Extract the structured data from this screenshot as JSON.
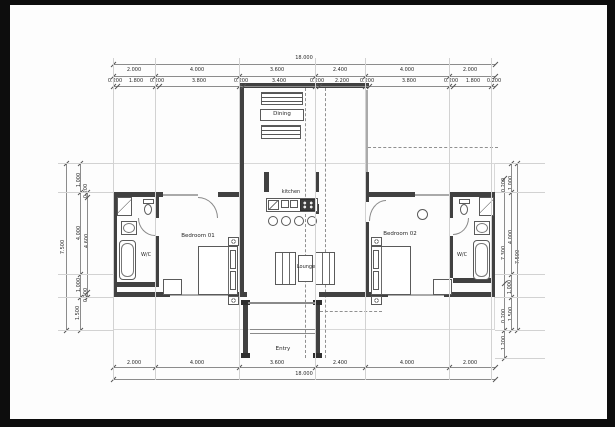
{
  "drawing": {
    "type": "architectural floor plan",
    "rooms": {
      "dining": "Dining",
      "kitchen": "kitchen",
      "lounge": "Lounge",
      "entry": "Entry",
      "bedroom1": "Bedroom 01",
      "bedroom2": "Bedroom 02",
      "wc_left": "W/C",
      "wc_right": "W/C"
    },
    "dimensions": {
      "overall_top": "18.000",
      "overall_bottom": "18.000",
      "top_segments": [
        "2.000",
        "4.000",
        "3.600",
        "2.400",
        "4.000",
        "2.000"
      ],
      "top_detail": [
        "0.200",
        "1.800",
        "0.200",
        "3.800",
        "0.200",
        "3.400",
        "0.200",
        "2.200",
        "0.200",
        "3.800",
        "0.200",
        "1.800",
        "0.200"
      ],
      "bottom_segments": [
        "2.000",
        "4.000",
        "3.600",
        "2.400",
        "4.000",
        "2.000"
      ],
      "left": [
        "7.500",
        "1.000",
        "0.200",
        "4.000",
        "4.600",
        "1.000",
        "0.200",
        "1.500"
      ],
      "right": [
        "0.200",
        "1.000",
        "4.000",
        "7.300",
        "7.500",
        "1.000",
        "0.200",
        "1.500",
        "1.200"
      ]
    },
    "colors": {
      "paper": "#fdfdfd",
      "frame": "#0d0d0d",
      "wall": "#414141",
      "line": "#8c8c8c"
    }
  }
}
